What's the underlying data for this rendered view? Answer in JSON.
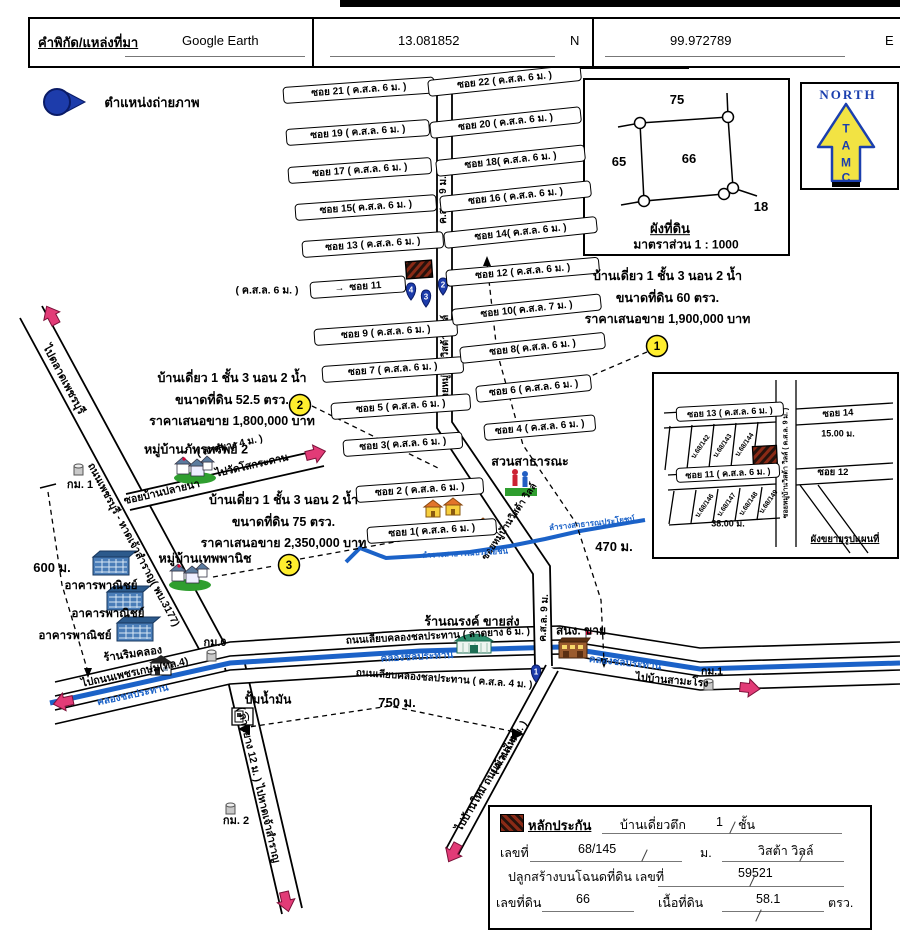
{
  "header": {
    "label": "คำพิกัด/แหล่งที่มา",
    "source": "Google Earth",
    "lat": "13.081852",
    "lat_dir": "N",
    "lng": "99.972789",
    "lng_dir": "E"
  },
  "legend": {
    "photo_label": "ตำแหน่งถ่ายภาพ"
  },
  "north_box": {
    "title": "NORTH",
    "letters": [
      "T",
      "A",
      "M",
      "C"
    ]
  },
  "plot_diagram": {
    "top": "75",
    "left": "65",
    "center": "66",
    "bottom_right": "18",
    "title": "ผังที่ดิน",
    "scale": "มาตราส่วน 1 : 1000"
  },
  "map": {
    "photo_markers": [
      "1",
      "2",
      "3",
      "4"
    ],
    "sois_left": [
      {
        "label": "ซอย 21 ( ค.ส.ล. 6 ม. )"
      },
      {
        "label": "ซอย 19 ( ค.ส.ล. 6 ม. )"
      },
      {
        "label": "ซอย 17 ( ค.ส.ล. 6 ม. )"
      },
      {
        "label": "ซอย 15( ค.ส.ล. 6 ม. )"
      },
      {
        "label": "ซอย 13 ( ค.ส.ล. 6 ม. )"
      },
      {
        "label": "ซอย 9  ( ค.ส.ล. 6 ม. )"
      },
      {
        "label": "ซอย 7  ( ค.ส.ล. 6 ม. )"
      },
      {
        "label": "ซอย 5 ( ค.ส.ล. 6 ม. )"
      },
      {
        "label": "ซอย 3( ค.ส.ล. 6 ม. )"
      },
      {
        "label": "ซอย 2 ( ค.ส.ล. 6 ม. )"
      },
      {
        "label": "ซอย 1( ค.ส.ล. 6 ม. )"
      }
    ],
    "sois_right": [
      {
        "label": "ซอย 22 ( ค.ส.ล. 6 ม. )"
      },
      {
        "label": "ซอย 20 ( ค.ส.ล. 6 ม. )"
      },
      {
        "label": "ซอย 18( ค.ส.ล. 6 ม. )"
      },
      {
        "label": "ซอย 16 ( ค.ส.ล. 6 ม. )"
      },
      {
        "label": "ซอย 14( ค.ส.ล. 6 ม. )"
      },
      {
        "label": "ซอย 12 ( ค.ส.ล. 6 ม. )"
      },
      {
        "label": "ซอย 10( ค.ส.ล. 7 ม. )"
      },
      {
        "label": "ซอย 8( ค.ส.ล. 6 ม. )"
      },
      {
        "label": "ซอย 6 ( ค.ส.ล. 6 ม. )"
      },
      {
        "label": "ซอย 4 ( ค.ส.ล. 6 ม. )"
      }
    ],
    "soi11_prefix": "( ค.ส.ล. 6 ม. )",
    "soi11_arrow": "→",
    "soi11_label": "ซอย 11",
    "main_road": {
      "top": "ค.ส.ล. 9 ม.",
      "name1": "ซอยหมู่บ้านวิสต้า วิลล์",
      "name2": "ซอยหมู่บ้านวิสต้า วิลล์",
      "bottom": "ค.ส.ล. 9 ม."
    },
    "listings": [
      {
        "num": "1",
        "line1": "บ้านเดี่ยว 1 ชั้น 3 นอน 2 น้ำ",
        "line2": "ขนาดที่ดิน 60 ตรว.",
        "line3": "ราคาเสนอขาย 1,900,000 บาท"
      },
      {
        "num": "2",
        "line1": "บ้านเดี่ยว 1 ชั้น 3 นอน 2 น้ำ",
        "line2": "ขนาดที่ดิน 52.5 ตรว.",
        "line3": "ราคาเสนอขาย 1,800,000 บาท"
      },
      {
        "num": "3",
        "line1": "บ้านเดี่ยว 1 ชั้น 3 นอน 2 น้ำ",
        "line2": "ขนาดที่ดิน 75 ตรว.",
        "line3": "ราคาเสนอขาย 2,350,000 บาท"
      }
    ],
    "places": {
      "village1": "หมู่บ้านภัทรทรัพย์ 2",
      "village2": "หมู่บ้านเทพพานิช",
      "park": "สวนสาธารณะ",
      "narong": "ร้านณรงค์ ขายส่ง",
      "sales_office": "สนง. ขาย",
      "rim_khlong": "ร้านริมคลอง",
      "gas": "ปั้มน้ำมัน",
      "commercial1": "อาคารพาณิชย์",
      "commercial2": "อาคารพาณิชย์",
      "commercial3": "อาคารพาณิชย์"
    },
    "roads": {
      "to_market": "ไปตลาดเพชรบุรี",
      "phetchaburi": "ถนนเพชรบุรี - หาดเจ้าสำราญ( พบ.3177)",
      "to_beach": "( ลาดยาง 12 ม. ) ไปหาดเจ้าสำราญ",
      "to_phetkasem": "ไปถนนเพชรเกษม(ทล.4)",
      "canal_road_top": "ถนนเลียบคลองชลประทาน ( ลาดยาง 6 ม. )",
      "canal_road_bottom": "ถนนเลียบคลองชลประทาน ( ค.ส.ล. 4 ม. )",
      "to_samrong": "ไปบ้านสามะโรง",
      "plai_na": "ซอยบ้านปลายนา",
      "to_wat": "ไปวัดโสกระดาน",
      "plai_na_width": "( ลาดยาง 4 ม. )",
      "to_ban_mai": "ไปบ้านใหม่  ถนนบ้านใหม่",
      "ban_mai_width": "( ค.ส.ล. 4 ม. )"
    },
    "waterways": {
      "canal1": "คลองชลประทาน",
      "canal2": "คลองชลประทาน",
      "canal3": "คลองชลประทาน",
      "stream1": "ลำรางสาธารณประโยชน์",
      "stream2": "ลำรางสาธารณประโยชน์"
    },
    "km_markers": {
      "km0": "กม.0",
      "km1_left": "กม. 1",
      "km1_right": "กม.1",
      "km2": "กม. 2"
    },
    "measurements": {
      "m600": "600 ม.",
      "m750": "750 ม.",
      "m470": "470 ม."
    }
  },
  "inset": {
    "soi13": "ซอย 13 ( ค.ส.ล. 6 ม. )",
    "soi11": "ซอย 11 ( ค.ส.ล. 6 ม. )",
    "soi14": "ซอย 14",
    "soi12": "ซอย 12",
    "vroad": "ซอยหมู่บ้านวิสต้า วิลล์ ( ค.ส.ล. 9 ม. )",
    "m15": "15.00 ม.",
    "m38": "38.00 ม.",
    "plots_top": [
      "บ.68/142",
      "บ.68/143",
      "บ.68/144"
    ],
    "plots_bottom": [
      "บ.68/146",
      "บ.68/147",
      "บ.68/148",
      "บ.68/149"
    ],
    "title": "ผังขยายรูปแผนที่"
  },
  "guarantee_table": {
    "title": "หลักประกัน",
    "house_type": "บ้านเดี่ยวตึก",
    "floors": "1",
    "floors_unit": "ชั้น",
    "no_label": "เลขที่",
    "no_value": "68/145",
    "moo_label": "ม.",
    "moo_value": "วิสต้า วิลล์",
    "deed_label": "ปลูกสร้างบนโฉนดที่ดิน เลขที่",
    "deed_value": "59521",
    "land_no_label": "เลขที่ดิน",
    "land_no_value": "66",
    "area_label": "เนื้อที่ดิน",
    "area_value": "58.1",
    "area_unit": "ตรว."
  },
  "colors": {
    "canal_blue": "#1b62c8",
    "marker_blue": "#1d3cab",
    "pink": "#e23b77",
    "highlight_yellow": "#ffee2e",
    "hatch_red": "#8a2a16",
    "north_yellow": "#f2e343",
    "north_blue": "#1b3fae"
  }
}
